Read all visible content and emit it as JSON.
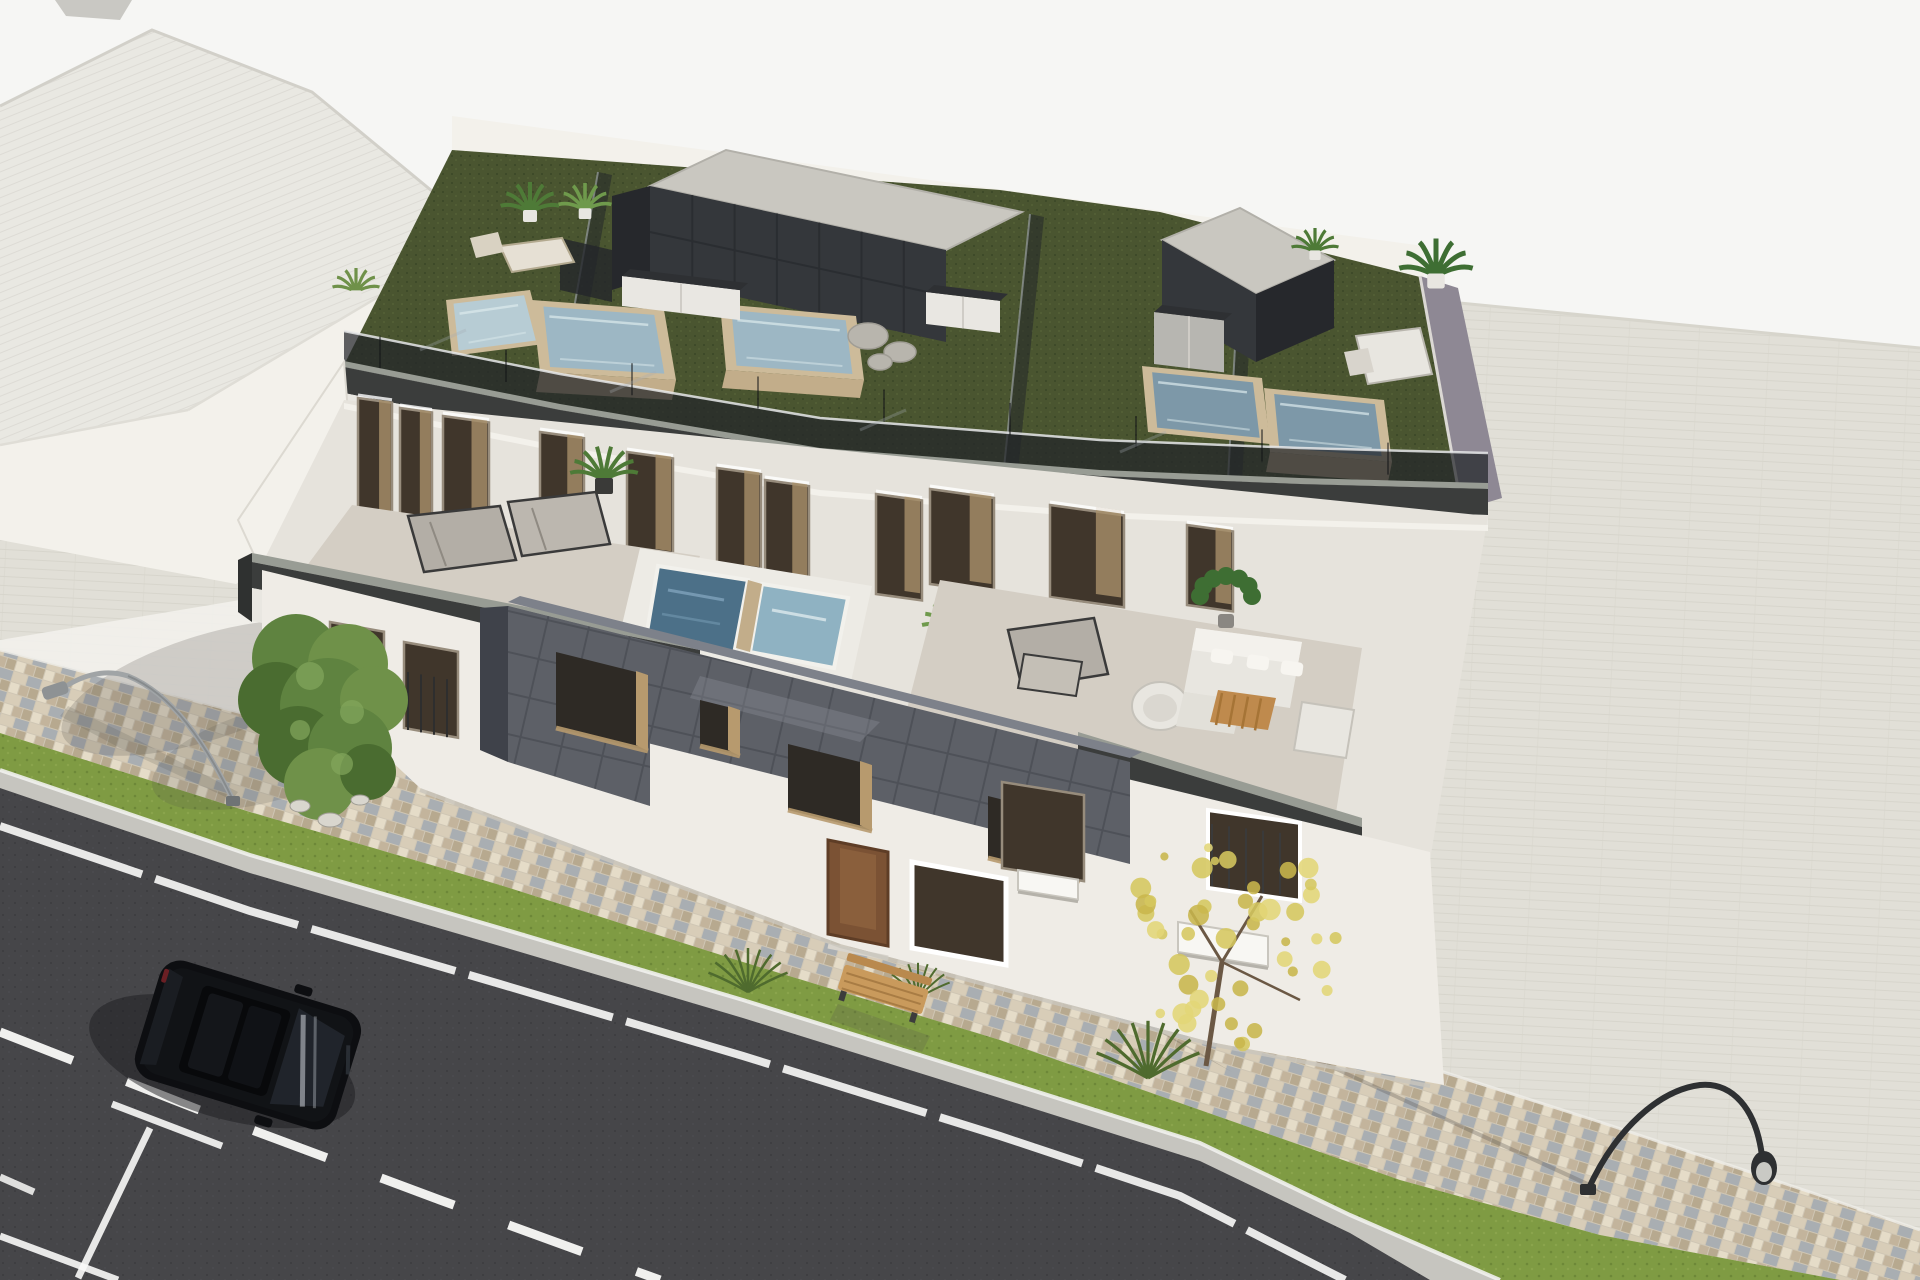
{
  "scene": {
    "kind": "3d-architectural-render",
    "view": "aerial-oblique",
    "subject": "modern-two-storey-apartment-building-with-rooftop-pool-terraces",
    "setting": "street-corner-with-parked-car-sidewalk-and-lawn-strips"
  },
  "inventory": {
    "rooftop_pools": 5,
    "terrace_jacuzzis": 2,
    "roof_stair_boxes": 2,
    "kitchen_counters": 3,
    "parked_cars": 1,
    "street_trees": 2,
    "street_lamps": 2,
    "benches": 1,
    "lounge_chairs": 6,
    "sofa_sets": 1
  },
  "palette": {
    "bg": "#f6f6f4",
    "neighbor_top": "#e9e8e2",
    "neighbor_front": "#f3f1eb",
    "neighbor_edge": "#d2d0c9",
    "plane": "#e1dfd7",
    "plane_line": "#d7d5cc",
    "plane_bright": "#f3f2ed",
    "cobble_a": "#d8cdb8",
    "cobble_b": "#c3b49c",
    "cobble_c": "#a9aeb2",
    "cobble_d": "#e5dcc8",
    "cobble_e": "#b7a98f",
    "cobble_f": "#cfc6b4",
    "grass": "#7f9b43",
    "grass_dark": "#6d8838",
    "grass_light": "#8fa850",
    "road": "#464649",
    "road_dot": "#3b3b3e",
    "road_light": "#515154",
    "curb": "#c6c5bf",
    "curb_white": "#f1f1ee",
    "marking": "#fafaf8",
    "shadow": "#55544f",
    "turf": "#4a5530",
    "turf_dot": "#3d4828",
    "turf_light": "#5a683a",
    "white_lit": "#f3f1eb",
    "white_mid": "#e6e3dc",
    "white_shade": "#d5d2ca",
    "fascia": "#3b3d3c",
    "fascia_cap": "#989c94",
    "glass_rail": "#23262a",
    "glass_reflect": "#a6abb2",
    "box_dark": "#34373b",
    "box_side": "#26282c",
    "box_top": "#c9c7c0",
    "box_joint": "#2a2d31",
    "pool_frame": "#cdbb9a",
    "pool_wood": "#c2ad8a",
    "water_light": "#b7ccd4",
    "water_mid": "#9db7c4",
    "water_deep": "#7d98a8",
    "water_dark": "#4c7088",
    "ripple": "#dce9ec",
    "counter_white": "#e9e7e2",
    "counter_top": "#2e3033",
    "counter_gray": "#b7b6b1",
    "terrace_floor": "#d4cec4",
    "tile_block": "#5d6067",
    "tile_joint": "#4e5158",
    "tile_side": "#3f424a",
    "tile_sheen": "#7d818a",
    "recess_tan": "#b79a6e",
    "window_glass": "#40362b",
    "window_frame": "#978c7c",
    "curtain": "#a8906a",
    "door_wood": "#7b5234",
    "door_panel": "#8a5f3c",
    "parapet_mauve": "#8e8894",
    "cushion": "#b3aea6",
    "sofa_white": "#e8e6e0",
    "sofa_hi": "#f3f1ec",
    "table_wood": "#bf8a4d",
    "table_line": "#a67436",
    "frame_dark": "#3a3a3a",
    "plant_green": "#4e7a37",
    "plant_dark": "#3e6e33",
    "plant_light": "#6f9a4c",
    "tree_green_1": "#5f8340",
    "tree_green_2": "#6f9149",
    "tree_green_3": "#4a6c30",
    "tree_green_hi": "#83a65c",
    "tree_yellow_1": "#d5c75e",
    "tree_yellow_2": "#c8b64c",
    "tree_yellow_3": "#e2d677",
    "trunk": "#5d4a33",
    "stone": "#b8b5ad",
    "stone_line": "#a09d95",
    "bench_wood": "#c99a5c",
    "bench_line": "#a87c44",
    "lamp_gray": "#a0a4a6",
    "lamp_black": "#2e3032",
    "car_body": "#0d0e11",
    "car_roof": "#08090b",
    "car_glass": "#20242b",
    "car_hi": "#343a42",
    "car_reflect": "#cfd4da",
    "car_shadow": "#1c1c1f"
  }
}
